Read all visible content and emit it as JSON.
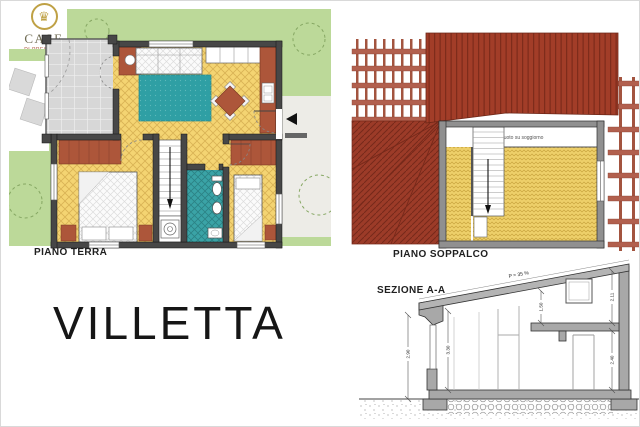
{
  "logo": {
    "title": "CASE",
    "subtitle": "DI PRESTIGIO",
    "emblem_icon": "crown-icon",
    "flag_colors": [
      "#2e8b6a",
      "#ffffff",
      "#c0392b"
    ]
  },
  "title": "VILLETTA",
  "labels": {
    "piano_terra": "PIANO TERRA",
    "piano_soppalco": "PIANO SOPPALCO",
    "sezione": "SEZIONE A-A"
  },
  "annotations": {
    "void_note": "Vuoto su soggiorno",
    "roof_slope": "P = 35 %"
  },
  "dimensions": {
    "left_outer": "2.90",
    "interior_left": "3.30",
    "mezzanine": "1.50",
    "right_upper": "2.11",
    "right_lower": "2.40"
  },
  "colors": {
    "lawn_green": "#bcd999",
    "floor_yellow": "#f4d472",
    "patio_grey": "#d7d7d7",
    "bath_teal": "#3aa3a6",
    "rug_teal": "#2f9fa4",
    "furniture_terracotta": "#ad563a",
    "roof_red": "#a23d28",
    "pergola_red": "#b2604e",
    "plan_wall": "#474747",
    "section_grey": "#a8a8a8"
  }
}
